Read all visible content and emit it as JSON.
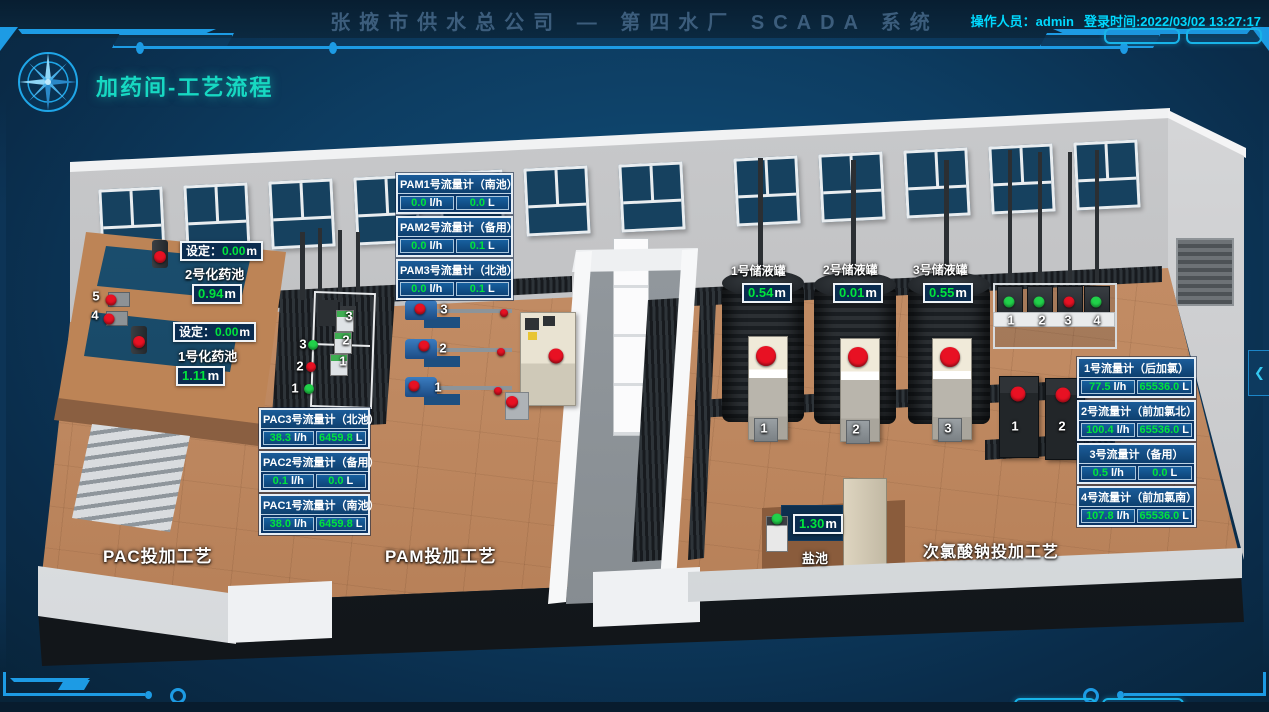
{
  "header": {
    "title": "张掖市供水总公司 — 第四水厂 SCADA 系统",
    "operator": "操作人员：admin",
    "login_time": "登录时间:2022/03/02 13:27:17"
  },
  "page": {
    "title": "加药间-工艺流程"
  },
  "panel_toggle": {
    "icon": "❮"
  },
  "colors": {
    "accent": "#1d9be4",
    "cyan_text": "#00d9ff",
    "title_teal": "#17d8c2",
    "value_green": "#00e53c",
    "alarm_red": "#e81123",
    "run_green": "#21d14a",
    "panel_blue": "#0b3a6b"
  },
  "flow_panels": {
    "pam": [
      {
        "title": "PAM1号流量计（南池）",
        "flow": "0.0",
        "flow_unit": "l/h",
        "total": "0.0",
        "total_unit": "L"
      },
      {
        "title": "PAM2号流量计（备用）",
        "flow": "0.0",
        "flow_unit": "l/h",
        "total": "0.1",
        "total_unit": "L"
      },
      {
        "title": "PAM3号流量计（北池）",
        "flow": "0.0",
        "flow_unit": "l/h",
        "total": "0.1",
        "total_unit": "L"
      }
    ],
    "pac": [
      {
        "title": "PAC3号流量计（北池）",
        "flow": "38.3",
        "flow_unit": "l/h",
        "total": "6459.8",
        "total_unit": "L"
      },
      {
        "title": "PAC2号流量计（备用）",
        "flow": "0.1",
        "flow_unit": "l/h",
        "total": "0.0",
        "total_unit": "L"
      },
      {
        "title": "PAC1号流量计（南池）",
        "flow": "38.0",
        "flow_unit": "l/h",
        "total": "6459.8",
        "total_unit": "L"
      }
    ],
    "chlorine": [
      {
        "title": "1号流量计（后加氯）",
        "flow": "77.5",
        "flow_unit": "l/h",
        "total": "65536.0",
        "total_unit": "L"
      },
      {
        "title": "2号流量计（前加氯北）",
        "flow": "100.4",
        "flow_unit": "l/h",
        "total": "65536.0",
        "total_unit": "L"
      },
      {
        "title": "3号流量计（备用）",
        "flow": "0.5",
        "flow_unit": "l/h",
        "total": "0.0",
        "total_unit": "L"
      },
      {
        "title": "4号流量计（前加氯南）",
        "flow": "107.8",
        "flow_unit": "l/h",
        "total": "65536.0",
        "total_unit": "L"
      }
    ]
  },
  "tanks": [
    {
      "name": "1号储液罐",
      "level": "0.54",
      "unit": "m"
    },
    {
      "name": "2号储液罐",
      "level": "0.01",
      "unit": "m"
    },
    {
      "name": "3号储液罐",
      "level": "0.55",
      "unit": "m"
    }
  ],
  "pools": [
    {
      "name": "2号化药池",
      "setpoint_label": "设定：",
      "setpoint": "0.00",
      "setpoint_unit": "m",
      "level": "0.94",
      "unit": "m"
    },
    {
      "name": "1号化药池",
      "setpoint_label": "设定：",
      "setpoint": "0.00",
      "setpoint_unit": "m",
      "level": "1.11",
      "unit": "m"
    }
  ],
  "salt_pool": {
    "name": "盐池",
    "level": "1.30",
    "unit": "m"
  },
  "area_labels": [
    "PAC投加工艺",
    "PAM投加工艺",
    "次氯酸钠投加工艺"
  ],
  "equipment": {
    "left_pumps": [
      "5",
      "4"
    ],
    "pac_pumps": [
      "1",
      "2",
      "3"
    ],
    "pac_meters": [
      "1",
      "2",
      "3"
    ],
    "pam_pumps": [
      "1",
      "2",
      "3"
    ],
    "dosing_units": [
      "1",
      "2",
      "3"
    ],
    "chlorine_rack": [
      "1",
      "2",
      "3",
      "4"
    ],
    "cabinets": [
      "1",
      "2"
    ]
  },
  "lights": {
    "pool_mixers": [
      "#e81123",
      "#e81123"
    ],
    "left_pumps": [
      "#e81123",
      "#e81123"
    ],
    "pac_skid": [
      "#21d14a",
      "#e81123",
      "#21d14a"
    ],
    "pam_pumps": [
      "#e81123",
      "#e81123",
      "#e81123"
    ],
    "pam_valves": [
      "#e81123",
      "#e81123",
      "#e81123"
    ],
    "pam_station": [
      "#e81123",
      "#e81123"
    ],
    "dosing_units": [
      "#e81123",
      "#e81123",
      "#e81123"
    ],
    "chlorine_rack": [
      "#21d14a",
      "#21d14a",
      "#e81123",
      "#21d14a"
    ],
    "cabinets": [
      "#e81123",
      "#e81123"
    ],
    "salt_pump": [
      "#21d14a"
    ]
  }
}
